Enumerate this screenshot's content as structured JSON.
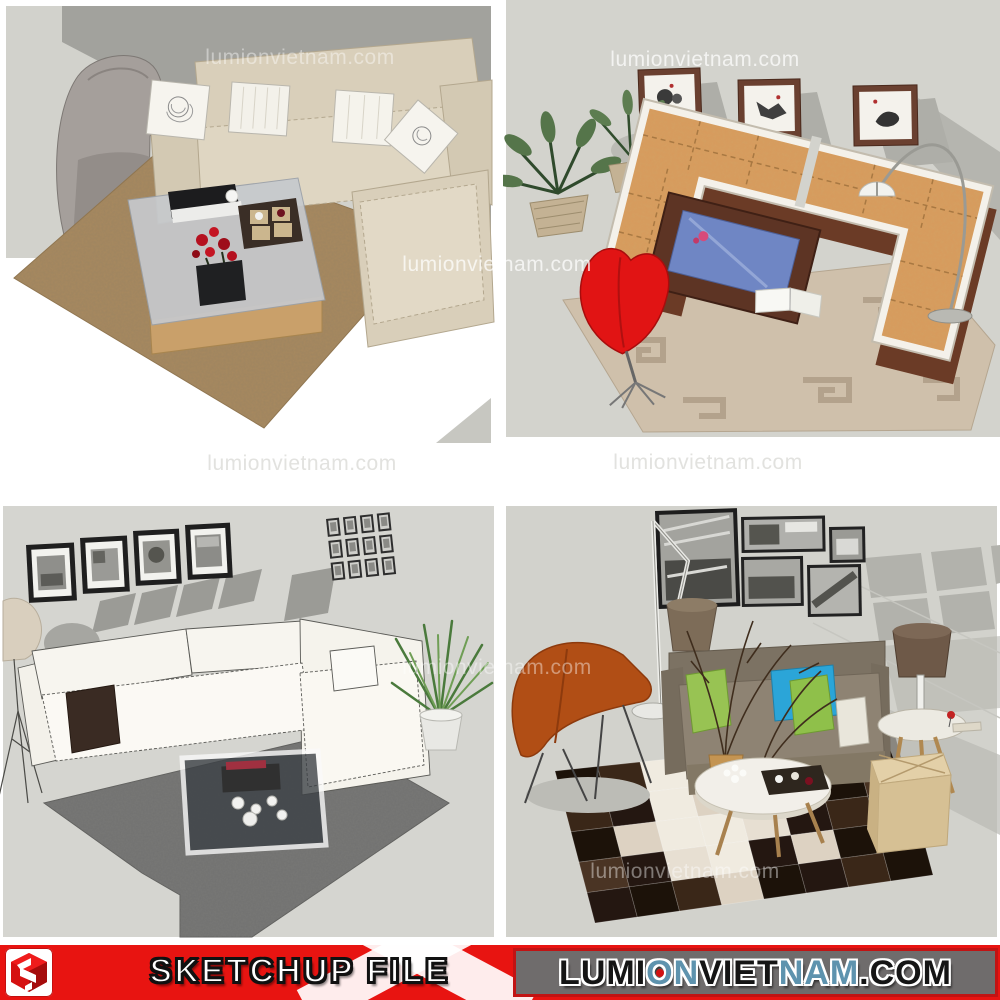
{
  "image_type": "sketchup-furniture-render-collage",
  "watermark": {
    "text": "lumionvietnam.com",
    "instances": [
      {
        "x": 300,
        "y": 58,
        "tone": "ghost"
      },
      {
        "x": 705,
        "y": 60,
        "tone": "white"
      },
      {
        "x": 497,
        "y": 265,
        "tone": "white"
      },
      {
        "x": 302,
        "y": 464,
        "tone": "gray-on-white"
      },
      {
        "x": 708,
        "y": 463,
        "tone": "gray-on-white"
      },
      {
        "x": 497,
        "y": 668,
        "tone": "ghost"
      },
      {
        "x": 685,
        "y": 872,
        "tone": "ghost"
      }
    ]
  },
  "quadrants": [
    {
      "alt": "Beige fabric sectional sofa with rose-print pillows, grey lounge chair, brown shaggy rug and decorated coffee table"
    },
    {
      "alt": "U-shaped rattan-cushion sofa with red shell chair, wooden coffee table, palm plants, arc floor lamp and three ink paintings"
    },
    {
      "alt": "White sketch-style sectional sofa with glass coffee table, dark grey rug, framed photos and potted plant"
    },
    {
      "alt": "Taupe sofa with green and blue pillows, rust sling chair, round coffee table, cowhide patchwork rug, pouf and black-and-white photo wall"
    }
  ],
  "banner": {
    "sketchup_label": "SKETCHUP FILE",
    "logo_name": "sketchup-logo",
    "background_red": "#e81411",
    "panel": {
      "background": "#6f6c6c",
      "border": "#c11313"
    },
    "site_text": "LUMION VIETNAM.COM",
    "site_parts": [
      {
        "text": "LUMI",
        "color": "#151515"
      },
      {
        "text": "O",
        "color": "#5e93ae",
        "dot": "#d11212"
      },
      {
        "text": "N",
        "color": "#5e93ae"
      },
      {
        "text": " VIET",
        "color": "#151515"
      },
      {
        "text": "NAM",
        "color": "#5e93ae"
      },
      {
        "text": ".COM",
        "color": "#151515"
      }
    ]
  },
  "palette": {
    "wall_gray": "#d3d3cd",
    "shadow_gray": "#a6a6a0",
    "sofa_beige": "#d9cfba",
    "rug_brown": "#a8895f",
    "cushion_orange": "#d89a5c",
    "chair_red": "#e11414",
    "rug_tan": "#cfc0ab",
    "rug_dark_gray": "#717170",
    "sofa_taupe": "#8e8373",
    "pillow_green": "#98c353",
    "pillow_blue": "#2ba5d8",
    "chair_rust": "#b14e15",
    "pouf_beige": "#e0cda6"
  }
}
